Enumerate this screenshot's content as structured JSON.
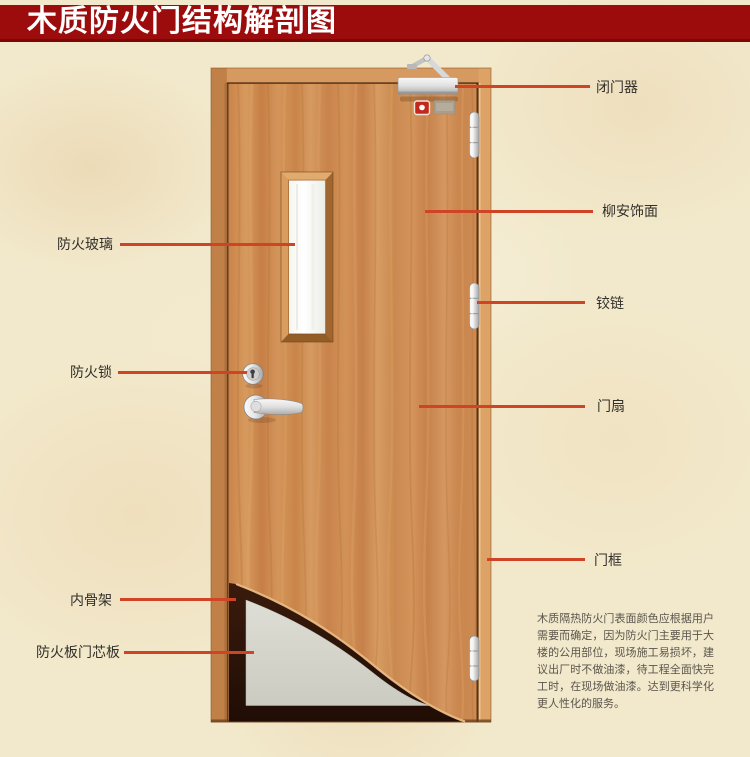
{
  "title": "木质防火门结构解剖图",
  "callouts": {
    "left": [
      {
        "label": "防火玻璃"
      },
      {
        "label": "防火锁"
      },
      {
        "label": "内骨架"
      },
      {
        "label": "防火板门芯板"
      }
    ],
    "right": [
      {
        "label": "闭门器"
      },
      {
        "label": "柳安饰面"
      },
      {
        "label": "铰链"
      },
      {
        "label": "门扇"
      },
      {
        "label": "门框"
      }
    ]
  },
  "description": "木质隔热防火门表面颜色应根据用户需要而确定，因为防火门主要用于大楼的公用部位，现场施工易损坏，建议出厂时不做油漆，待工程全面快完工时，在现场做油漆。达到更科学化更人性化的服务。",
  "colors": {
    "banner": "#9D0C0C",
    "banner_text": "#FFFFFF",
    "background": "#F2E9CC",
    "callout_line": "#CE4425",
    "label_text": "#33302B",
    "wood": "#CD8A4E",
    "core_panel": "#D6D6CC",
    "skeleton": "#2E150A"
  }
}
